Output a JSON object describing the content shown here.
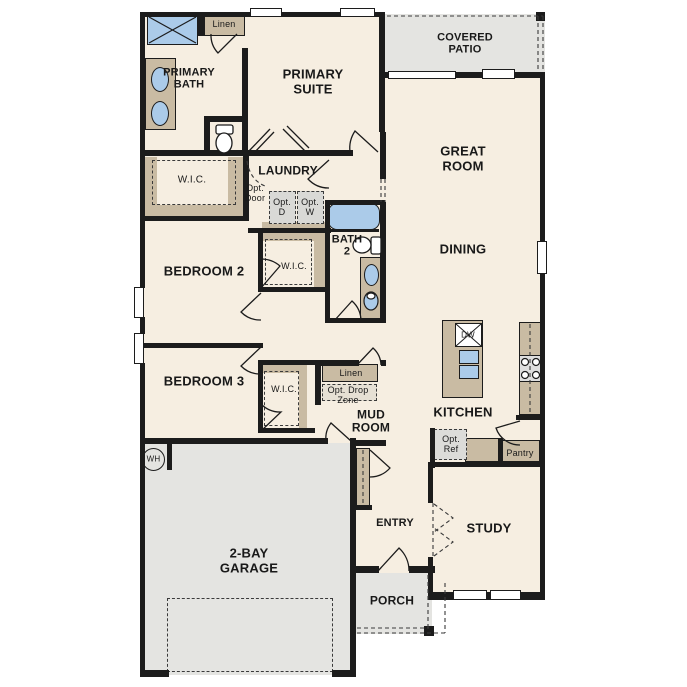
{
  "colors": {
    "wall": "#1c1c1c",
    "interior_floor": "#f6eee1",
    "outdoor_and_garage": "#e4e4e1",
    "cabinetry_tan": "#c9bba3",
    "fixture_blue": "#abcbe9",
    "optional_item_fill": "#dcdcd9"
  },
  "labels": {
    "covered_patio": "COVERED\nPATIO",
    "primary_suite": "PRIMARY\nSUITE",
    "primary_bath": "PRIMARY\nBATH",
    "linen_bath": "Linen",
    "wic_primary": "W.I.C.",
    "laundry": "LAUNDRY",
    "opt_door": "Opt.\nDoor",
    "opt_d": "Opt.\nD",
    "opt_w": "Opt.\nW",
    "great_room": "GREAT\nROOM",
    "dining": "DINING",
    "bath_2": "BATH\n2",
    "wic_bed2": "W.I.C.",
    "bedroom_2": "BEDROOM 2",
    "bedroom_3": "BEDROOM 3",
    "wic_bed3": "W.I.C.",
    "linen_mud": "Linen",
    "opt_drop_zone": "Opt. Drop\nZone",
    "mud_room": "MUD\nROOM",
    "kitchen": "KITCHEN",
    "dishwasher": "DW",
    "opt_ref": "Opt.\nRef",
    "pantry": "Pantry",
    "study": "STUDY",
    "entry": "ENTRY",
    "porch": "PORCH",
    "garage": "2-BAY\nGARAGE",
    "water_heater": "WH"
  }
}
